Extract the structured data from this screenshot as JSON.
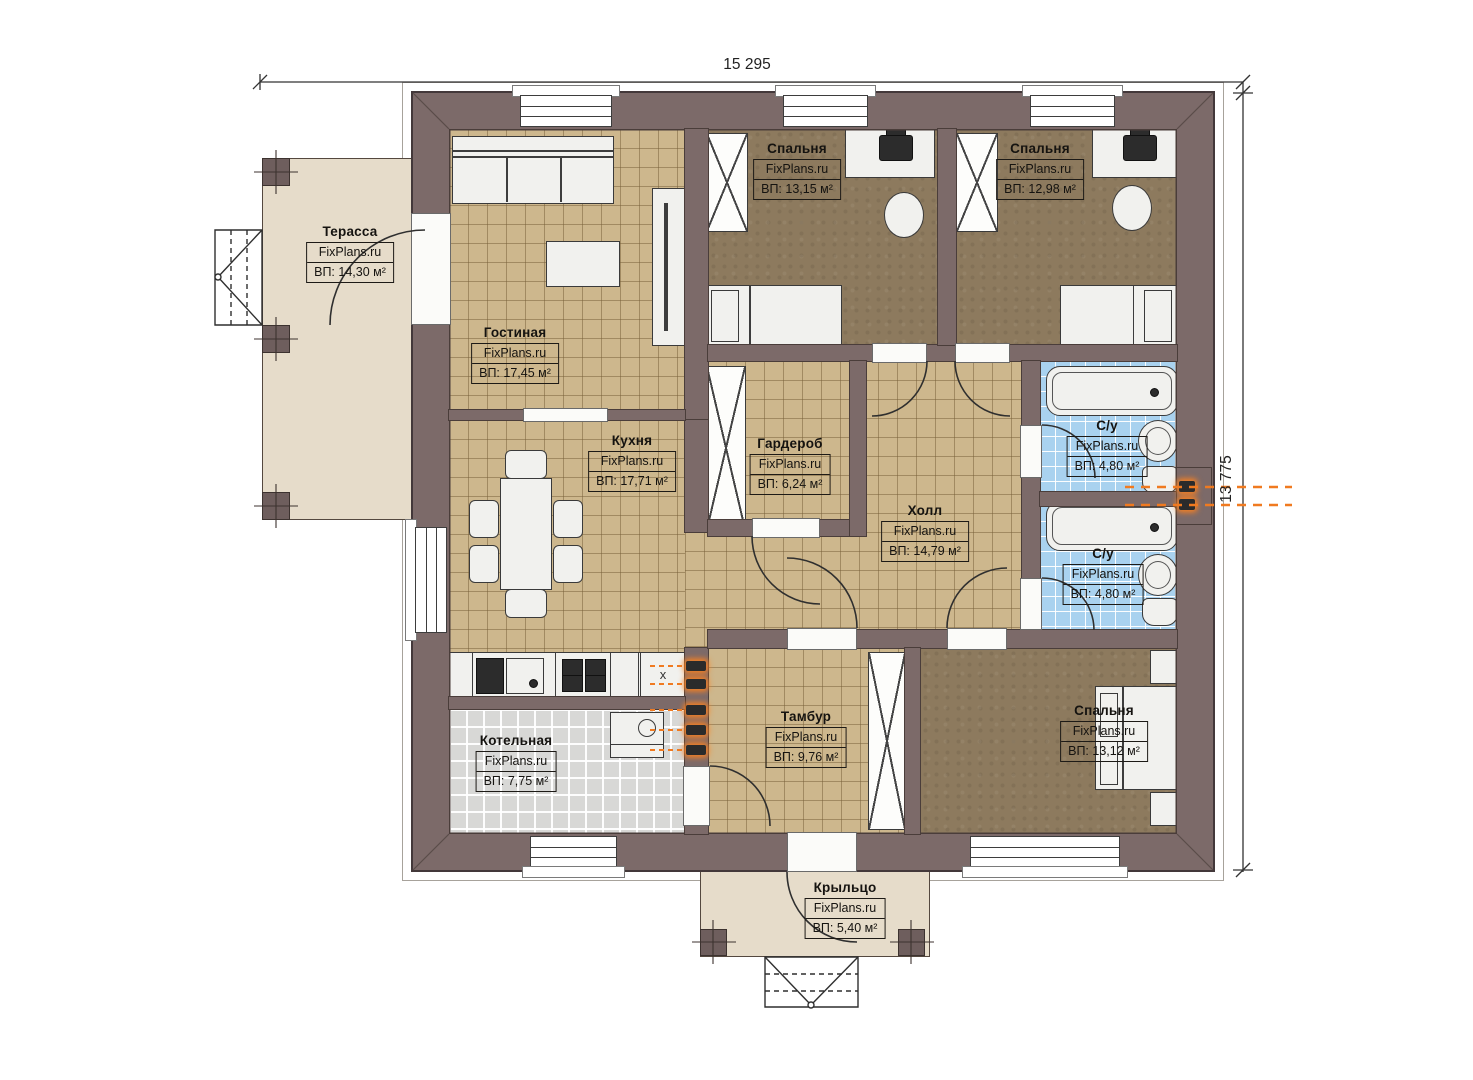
{
  "watermark": "FixPlans.ru",
  "dimensions": {
    "width_label": "15 295",
    "height_label": "13 775"
  },
  "rooms": [
    {
      "id": "terrace",
      "name": "Терасса",
      "watermark": "FixPlans.ru",
      "area": "ВП: 14,30 м²"
    },
    {
      "id": "living",
      "name": "Гостиная",
      "watermark": "FixPlans.ru",
      "area": "ВП: 17,45 м²"
    },
    {
      "id": "bedroom1",
      "name": "Спальня",
      "watermark": "FixPlans.ru",
      "area": "ВП: 13,15 м²"
    },
    {
      "id": "bedroom2",
      "name": "Спальня",
      "watermark": "FixPlans.ru",
      "area": "ВП: 12,98 м²"
    },
    {
      "id": "wardrobe",
      "name": "Гардероб",
      "watermark": "FixPlans.ru",
      "area": "ВП: 6,24 м²"
    },
    {
      "id": "hall",
      "name": "Холл",
      "watermark": "FixPlans.ru",
      "area": "ВП: 14,79 м²"
    },
    {
      "id": "bath1",
      "name": "С/у",
      "watermark": "FixPlans.ru",
      "area": "ВП: 4,80 м²"
    },
    {
      "id": "bath2",
      "name": "С/у",
      "watermark": "FixPlans.ru",
      "area": "ВП: 4,80 м²"
    },
    {
      "id": "kitchen",
      "name": "Кухня",
      "watermark": "FixPlans.ru",
      "area": "ВП: 17,71 м²"
    },
    {
      "id": "boiler",
      "name": "Котельная",
      "watermark": "FixPlans.ru",
      "area": "ВП: 7,75 м²"
    },
    {
      "id": "tambour",
      "name": "Тамбур",
      "watermark": "FixPlans.ru",
      "area": "ВП: 9,76 м²"
    },
    {
      "id": "bedroom3",
      "name": "Спальня",
      "watermark": "FixPlans.ru",
      "area": "ВП: 13,12 м²"
    },
    {
      "id": "porch",
      "name": "Крыльцо",
      "watermark": "FixPlans.ru",
      "area": "ВП: 5,40 м²"
    }
  ],
  "misc": {
    "cabinet_x": "х"
  },
  "colors": {
    "wall": "#7c6a69",
    "floor_tile_tan": "#cdb78d",
    "floor_bedroom": "#8d7a5e",
    "floor_bathroom": "#a9d2ef",
    "floor_boiler": "#d8d8d6",
    "floor_outdoor": "#e6dcca",
    "accent_radiator": "#f07a20"
  }
}
